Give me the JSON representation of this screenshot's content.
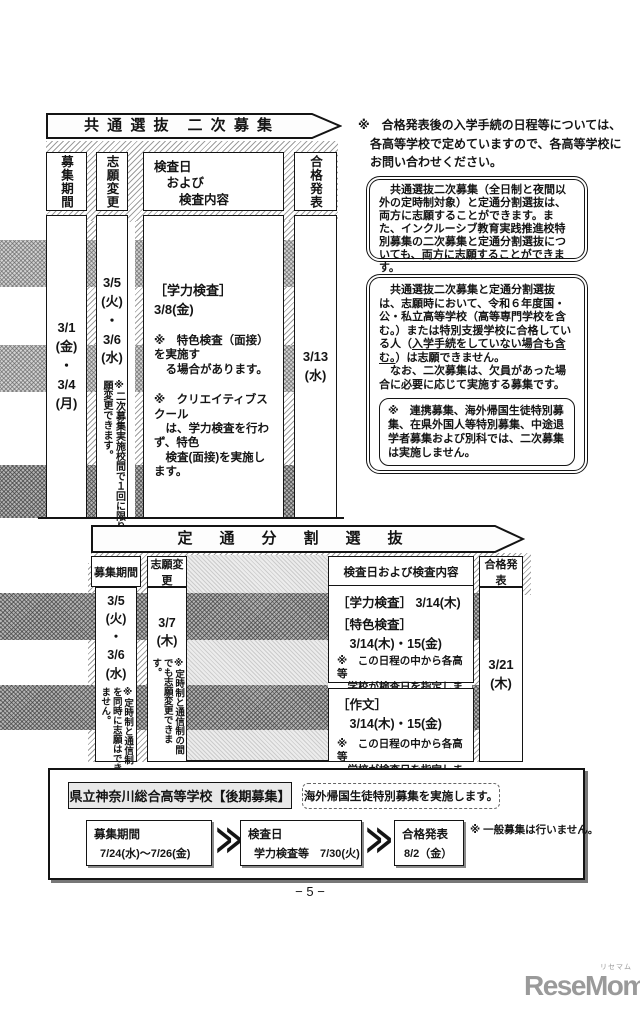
{
  "colors": {
    "ink": "#141414",
    "title_bg": "#e9e9e9",
    "logo_gray": "#9a9a9a",
    "hatch_gray": "#9e9e9e"
  },
  "notes": {
    "top": "※　合格発表後の入学手続の日程等については、\n　各高等学校で定めていますので、各高等学校に\n　お問い合わせください。",
    "box1": "　共通選抜二次募集（全日制と夜間以外の定時制対象）と定通分割選抜は、両方に志願することができます。また、インクルーシブ教育実践推進校特別募集の二次募集と定通分割選抜についても、両方に志願することができます。",
    "box2_pre": "　共通選抜二次募集と定通分割選抜は、志願時において、令和６年度国・公・私立高等学校（高等専門学校を含む。）または特別支援学校に合格している人（",
    "box2_u": "入学手続をしていない場合も含む。",
    "box2_post": "）は志願できません。\n　なお、二次募集は、欠員があった場合に必要に応じて実施する募集です。",
    "box2_inner": "※　連携募集、海外帰国生徒特別募集、在県外国人等特別募集、中途退学者募集および別科では、二次募集は実施しません。"
  },
  "table1": {
    "banner": "共 通 選 抜　二 次 募 集",
    "headers": {
      "col1": "募集期間",
      "col2": "志願変更",
      "col3": "検査日\n　および\n　　検査内容",
      "col4": "合格発表"
    },
    "col1_dates": "3/1\n(金)\n・\n3/4\n(月)",
    "col2_dates": "3/5\n(火)\n・\n3/6\n(水)",
    "col2_note": "※二次募集実施校間で１回に限り志願変更できます。",
    "col3_exam": "［学力検査］ 3/8(金)",
    "col3_note1": "※　特色検査（面接）を実施す\n　る場合があります。",
    "col3_note2": "※　クリエイティブスクール\n　は、学力検査を行わず、特色\n　検査(面接)を実施します。",
    "col4_date": "3/13\n(水)"
  },
  "table2": {
    "banner": "定　通　分　割　選　抜",
    "headers": {
      "col1": "募集期間",
      "col2": "志願変更",
      "col3": "検査日および検査内容",
      "col4": "合格発表"
    },
    "col1_dates": "3/5\n(火)\n・\n3/6\n(水)",
    "col1_note": "※定時制と通信制を同時に志願はできません。",
    "col2_date": "3/7\n(木)",
    "col2_note": "※定時制と通信制の間でも志願変更できます。",
    "exam1_line1": "［学力検査］ 3/14(木)",
    "exam1_line2": "［特色検査］",
    "exam1_line3": "　3/14(木)・15(金)",
    "exam1_note": "※　この日程の中から各高等\n　学校が検査日を指定します。",
    "exam2_line1": "［作文］",
    "exam2_line2": "　3/14(木)・15(金)",
    "exam2_note": "※　この日程の中から各高等\n　学校が検査日を指定します。",
    "col4_date": "3/21\n(木)"
  },
  "bottom": {
    "title": "県立神奈川総合高等学校【後期募集】",
    "dashed_note": "海外帰国生徒特別募集を実施します。",
    "flow": [
      {
        "label": "募集期間",
        "value": "7/24(水)～7/26(金)"
      },
      {
        "label": "検査日",
        "value": "学力検査等　7/30(火)"
      },
      {
        "label": "合格発表",
        "value": "8/2（金）"
      }
    ],
    "chevron": "≫",
    "note": "※ 一般募集は行いません。"
  },
  "footer": {
    "page_number": "− 5 −"
  },
  "logo": {
    "text": "ReseMom.",
    "ruby": "リセマム"
  }
}
